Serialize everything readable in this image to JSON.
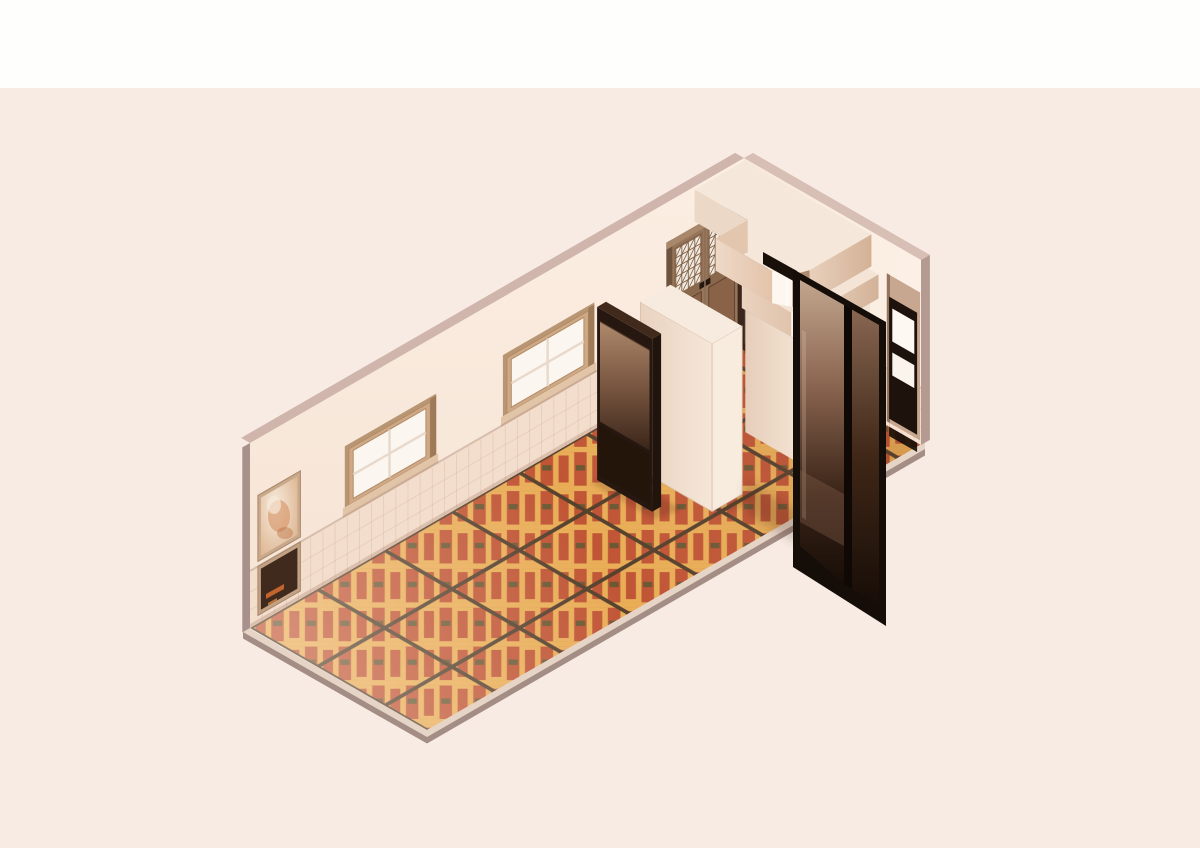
{
  "scene": {
    "type": "isometric-room-render",
    "objects": [
      "patterned-tile-floor",
      "long-back-wall",
      "end-wall",
      "wall-top-edge",
      "framed-picture-upper",
      "framed-picture-lower",
      "window-left",
      "window-right",
      "lattice-french-doors",
      "display-cabinet",
      "partition-box",
      "vestibule-cabinet",
      "overhead-soffit",
      "lower-soffit-slab",
      "dark-glass-double-doors",
      "end-wall-door",
      "floor-slab-edge"
    ]
  },
  "colors": {
    "bg_top": "#fefefd",
    "bg": "#f8ebe3",
    "wall": "#f6e3d4",
    "wall_light": "#fbeee2",
    "wainscot": "#f3ddcd",
    "wall_ne": "#f8e8da",
    "wall_ne_light": "#fcf1e7",
    "grid_line": "#c8a08c",
    "rail": "#d8bead",
    "base_shadow": "#8a5a40",
    "edge_top_nw": "#cfb5ac",
    "edge_end_left": "#a8918b",
    "edge_top_ne": "#d8bfb5",
    "edge_end_right": "#b49a91",
    "slab_edge": "#e6d4c6",
    "slab_edge_dark": "#a38d85",
    "floor_red": "#c05535",
    "floor_yellow": "#e9ad56",
    "floor_olive": "#6b5833",
    "floor_grout": "#55402c",
    "sheen_light": "#fff7ef",
    "sheen_dark": "#5f2d1c",
    "casing": "#b89573",
    "frame": "#cfa985",
    "reveal": "#9f7a58",
    "sill": "#e2c5a6",
    "sill_shadow": "#b98f6b",
    "glass": "#fbf6f0",
    "muntin": "#e8d9cb",
    "frame_inner": "#b28c68",
    "pic_frame": "#c9a98b",
    "pic_frame2": "#c2a284",
    "art_a": "#f6ebdd",
    "art_b": "#dcb089",
    "art_blob1": "#d4895a",
    "art_blob2": "#f6e8d8",
    "art_blob3": "#b86a3a",
    "poster_bg": "#402a1d",
    "poster_orange": "#cf6a31",
    "poster_orange2": "#d98a3f",
    "doorway_reveal": "#8a6f58",
    "doorway_reveal_dark": "#6e543e",
    "header": "#a8876a",
    "leaf_frame": "#96755a",
    "lattice_bg": "#f2eae0",
    "lattice_line": "#7d5f45",
    "mid_rail": "#8a684c",
    "handle": "#241710",
    "panel_top": "#8a6248",
    "panel_bot": "#3f2616",
    "bottom_rail": "#6b4b35",
    "under_door": "#3a2618",
    "threshold": "#ffffff",
    "vest_dark": "#2f1d12",
    "box_l_a": "#e9d2c0",
    "box_l_b": "#f6e7d8",
    "box_r": "#f8ecdf",
    "box_top": "#f6ebde",
    "box_edge": "#d9bda9",
    "cab_frame": "#261710",
    "cab_glass_top": "#bb9678",
    "cab_glass_mid": "#7a5741",
    "cab_glass_bot": "#2c1a10",
    "cab_side": "#20140d",
    "cab_lower": "#231509",
    "cab_roof": "#41291c",
    "vcab_l_a": "#e6cdb9",
    "vcab_l_b": "#f4e3d3",
    "vcab_r": "#f3e5d6",
    "vcab_top": "#f6eadc",
    "slab_top": "#f3e4d5",
    "slab_l_a": "#ead3c0",
    "slab_l_b": "#e0c3ab",
    "slab_r_a": "#e9d2bf",
    "slab_r_b": "#d2b196",
    "chrome_light": "#fbf3ea",
    "chrome_dark": "#b99478",
    "soffit_top": "#f5e8da",
    "soffit_l1": "#ecd8c7",
    "soffit_jog": "#e2c6ad",
    "soffit_l2a": "#eed9c8",
    "soffit_l2b": "#e3c3a9",
    "soffit_chrome_light": "#fdf7f0",
    "soffit_chrome_dark": "#ad8a70",
    "soffit_r_a": "#e9d1bd",
    "soffit_r_b": "#d3b195",
    "unit_header": "#1a100a",
    "unit_frame": "#150d08",
    "unit_divider": "#0f0804",
    "unit_glass_top": "#c4a78f",
    "unit_glass_hi": "#8a6550",
    "unit_glass_lo": "#3a2417",
    "unit_glass_bot": "#170d07",
    "unit_glass_r_top": "#8a6854",
    "unit_glass_r_mid": "#402717",
    "unit_reflect": "#e8d5c4",
    "unit_patch": "#8a6450",
    "ne_recess": "#c7a78f",
    "ne_recess_dark": "#6b4a35",
    "ne_door": "#1d120c",
    "ne_pane1": "#fdf8f2",
    "ne_pane2": "#fbf4ec",
    "ne_door_shadow": "#140c07",
    "shadow": "#3c1d0f"
  }
}
